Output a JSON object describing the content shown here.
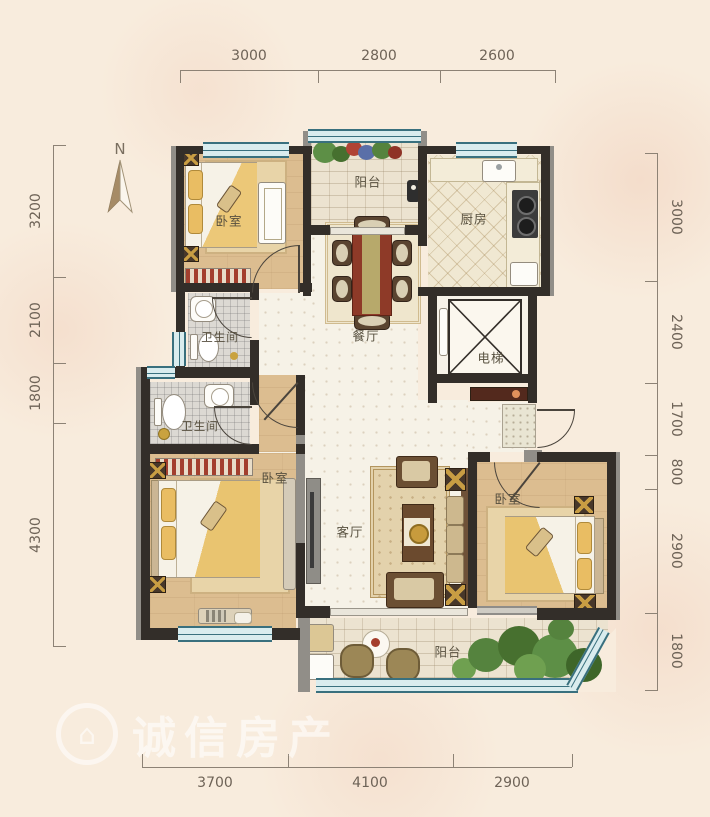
{
  "north": {
    "label": "N"
  },
  "watermark": {
    "text": "诚信房产",
    "logo_glyph": "⌂"
  },
  "dimensions": {
    "top": [
      "3000",
      "2800",
      "2600"
    ],
    "bottom": [
      "3700",
      "4100",
      "2900"
    ],
    "left": [
      "3200",
      "2100",
      "1800",
      "4300"
    ],
    "right": [
      "3000",
      "2400",
      "1700",
      "800",
      "2900",
      "1800"
    ]
  },
  "rooms": {
    "bedroom_top_left": {
      "label": "卧室"
    },
    "balcony_top": {
      "label": "阳台"
    },
    "kitchen": {
      "label": "厨房"
    },
    "dining": {
      "label": "餐厅"
    },
    "elevator": {
      "label": "电梯"
    },
    "bathroom_upper": {
      "label": "卫生间"
    },
    "bathroom_lower": {
      "label": "卫生间"
    },
    "bedroom_left": {
      "label": "卧室"
    },
    "living": {
      "label": "客厅"
    },
    "bedroom_right": {
      "label": "卧室"
    },
    "balcony_bottom": {
      "label": "阳台"
    }
  },
  "colors": {
    "background": "#f8ecdd",
    "wall": "#332e29",
    "window": "#39707e",
    "wood_floor": "#dcbd90",
    "accent_gold": "#c89d43",
    "table_red": "#8e3a28"
  }
}
